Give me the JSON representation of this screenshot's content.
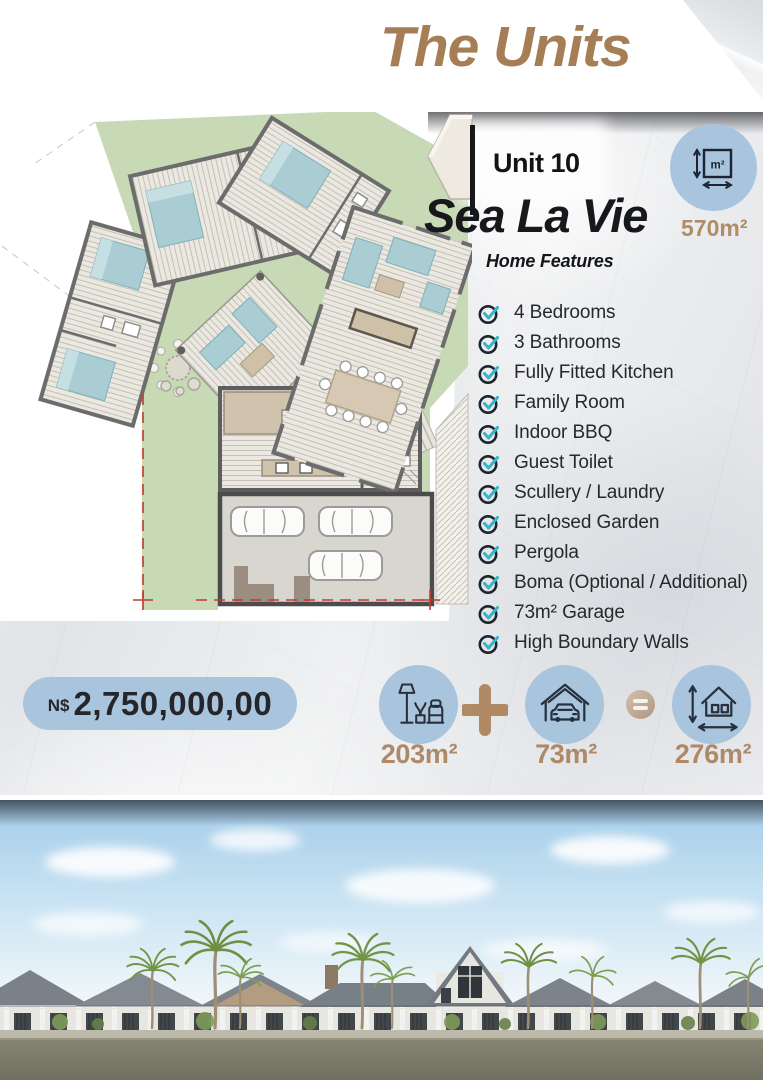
{
  "header": {
    "title": "The Units"
  },
  "unit": {
    "label": "Unit 10",
    "name": "Sea La Vie",
    "total_area": "570m²",
    "area_badge_unit": "m²",
    "features_heading": "Home Features",
    "features": [
      "4 Bedrooms",
      "3 Bathrooms",
      "Fully Fitted Kitchen",
      "Family Room",
      "Indoor BBQ",
      "Guest Toilet",
      "Scullery / Laundry",
      "Enclosed Garden",
      "Pergola",
      "Boma (Optional / Additional)",
      "73m² Garage",
      "High Boundary Walls"
    ]
  },
  "price": {
    "currency": "N$",
    "amount": "2,750,000,00"
  },
  "breakdown": {
    "interior": {
      "value": "203m²",
      "icon": "furniture-icon"
    },
    "plus": "+",
    "garage": {
      "value": "73m²",
      "icon": "garage-icon"
    },
    "equals": "=",
    "total": {
      "value": "276m²",
      "icon": "house-dimensions-icon"
    }
  },
  "colors": {
    "accent_tan": "#a57e56",
    "accent_blue": "#a9c4dd",
    "check_teal": "#38b6c9",
    "garden_green": "#c7d9b5"
  }
}
